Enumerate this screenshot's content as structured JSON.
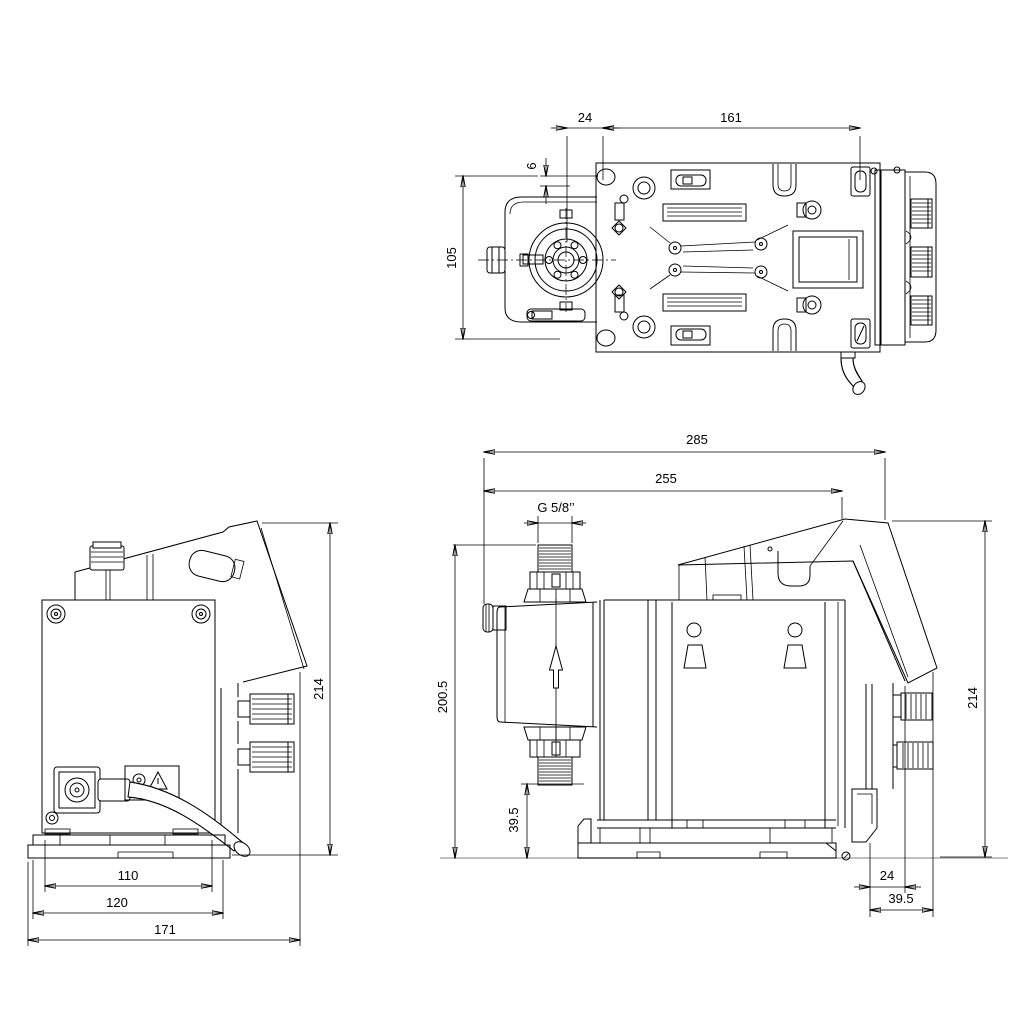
{
  "line_color": "#000000",
  "ground_color": "#9a9a9a",
  "dims": {
    "top": {
      "d24": "24",
      "d161": "161",
      "d6": "6",
      "d105": "105"
    },
    "back": {
      "d214": "214",
      "d110": "110",
      "d120": "120",
      "d171": "171"
    },
    "side": {
      "d285": "285",
      "d255": "255",
      "thread": "G 5/8’’",
      "d200_5": "200.5",
      "d39_5_suction": "39.5",
      "d214": "214",
      "d24": "24",
      "d39_5_rear": "39.5"
    }
  }
}
